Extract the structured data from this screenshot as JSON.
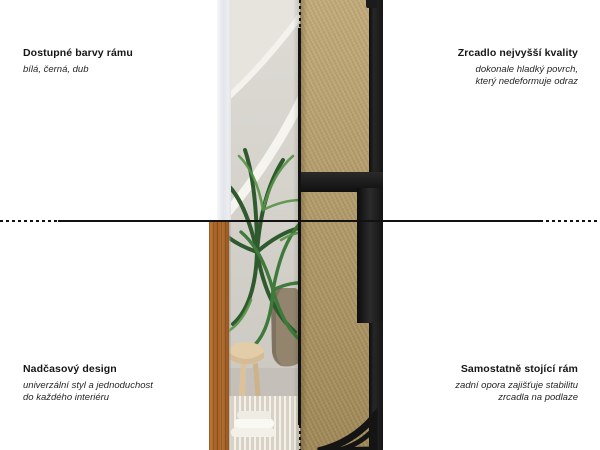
{
  "page": {
    "background": "#ffffff",
    "kind": "product feature infographic of a free-standing floor mirror, front view (left) and back view (right) divided by dotted crosshair lines"
  },
  "annotations": {
    "top_left": {
      "title": "Dostupné barvy rámu",
      "subtitle": [
        "bílá, černá, dub"
      ]
    },
    "top_right": {
      "title": "Zrcadlo nejvyšší kvality",
      "subtitle": [
        "dokonale hladký povrch,",
        "který nedeformuje odraz"
      ]
    },
    "bottom_left": {
      "title": "Nadčasový design",
      "subtitle": [
        "univerzální styl a jednoduchost",
        "do každého interiéru"
      ]
    },
    "bottom_right": {
      "title": "Samostatně stojící rám",
      "subtitle": [
        "zadní opora zajišťuje stabilitu",
        "zrcadla na podlaze"
      ]
    }
  },
  "colors": {
    "text": "#1a1a1a",
    "divider_line": "#121212",
    "frame_white": "#e9ebee",
    "frame_oak": "#cfa065",
    "frame_black": "#1d1d1d",
    "mdf_board": "#b59b64",
    "mirror_wall": "#d6d3cd",
    "plant_green": "#3c7339"
  }
}
